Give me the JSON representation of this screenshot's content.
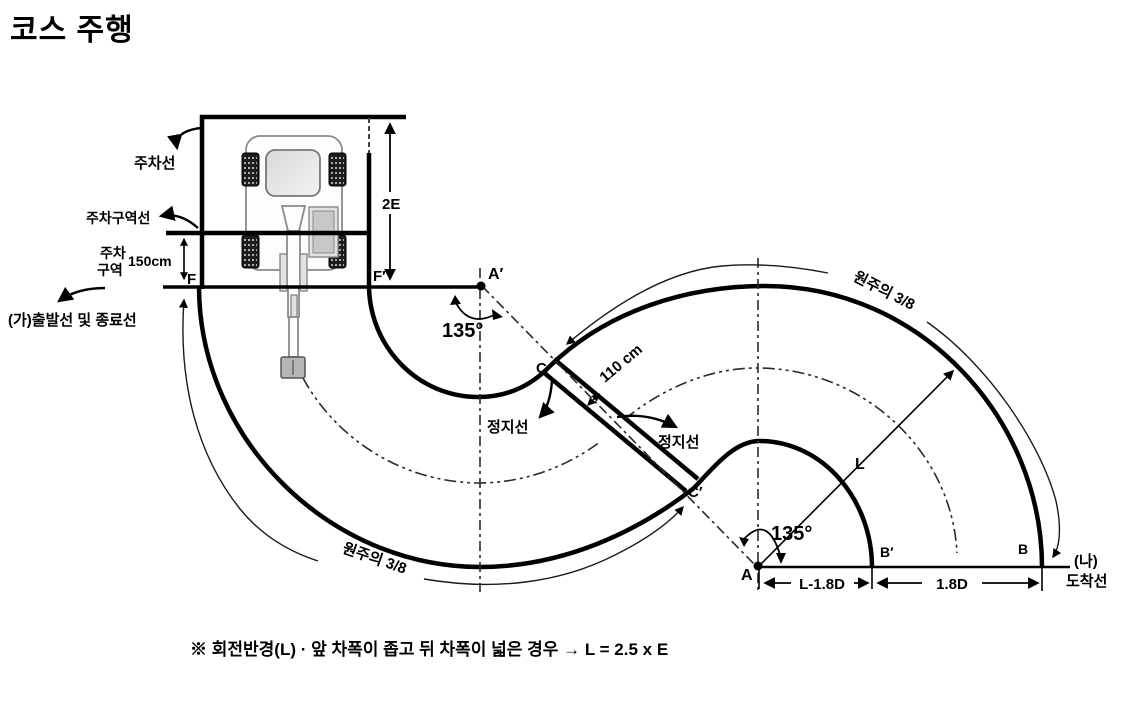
{
  "title": "코스 주행",
  "note": "※ 회전반경(L) · 앞 차폭이 좁고 뒤 차폭이 넓은 경우 → L = 2.5 x E",
  "labels": {
    "parking_line": "주차선",
    "parking_zone_line": "주차구역선",
    "parking_zone_1": "주차",
    "parking_zone_2": "구역",
    "parking_zone_width": "150cm",
    "height_2e": "2E",
    "f": "F",
    "f_prime": "F′",
    "start_end_line": "(가)출발선 및 종료선",
    "a_prime": "A′",
    "angle_left": "135°",
    "c": "C",
    "corridor_width": "110 cm",
    "stop_line_left": "정지선",
    "stop_line_right": "정지선",
    "c_prime": "C′",
    "angle_right": "135°",
    "a": "A",
    "b_prime": "B′",
    "b": "B",
    "radius_l": "L",
    "dim_left": "L-1.8D",
    "dim_right": "1.8D",
    "arc_left": "원주의 3/8",
    "arc_right": "원주의 3/8",
    "finish_1": "(나)",
    "finish_2": "도착선"
  }
}
